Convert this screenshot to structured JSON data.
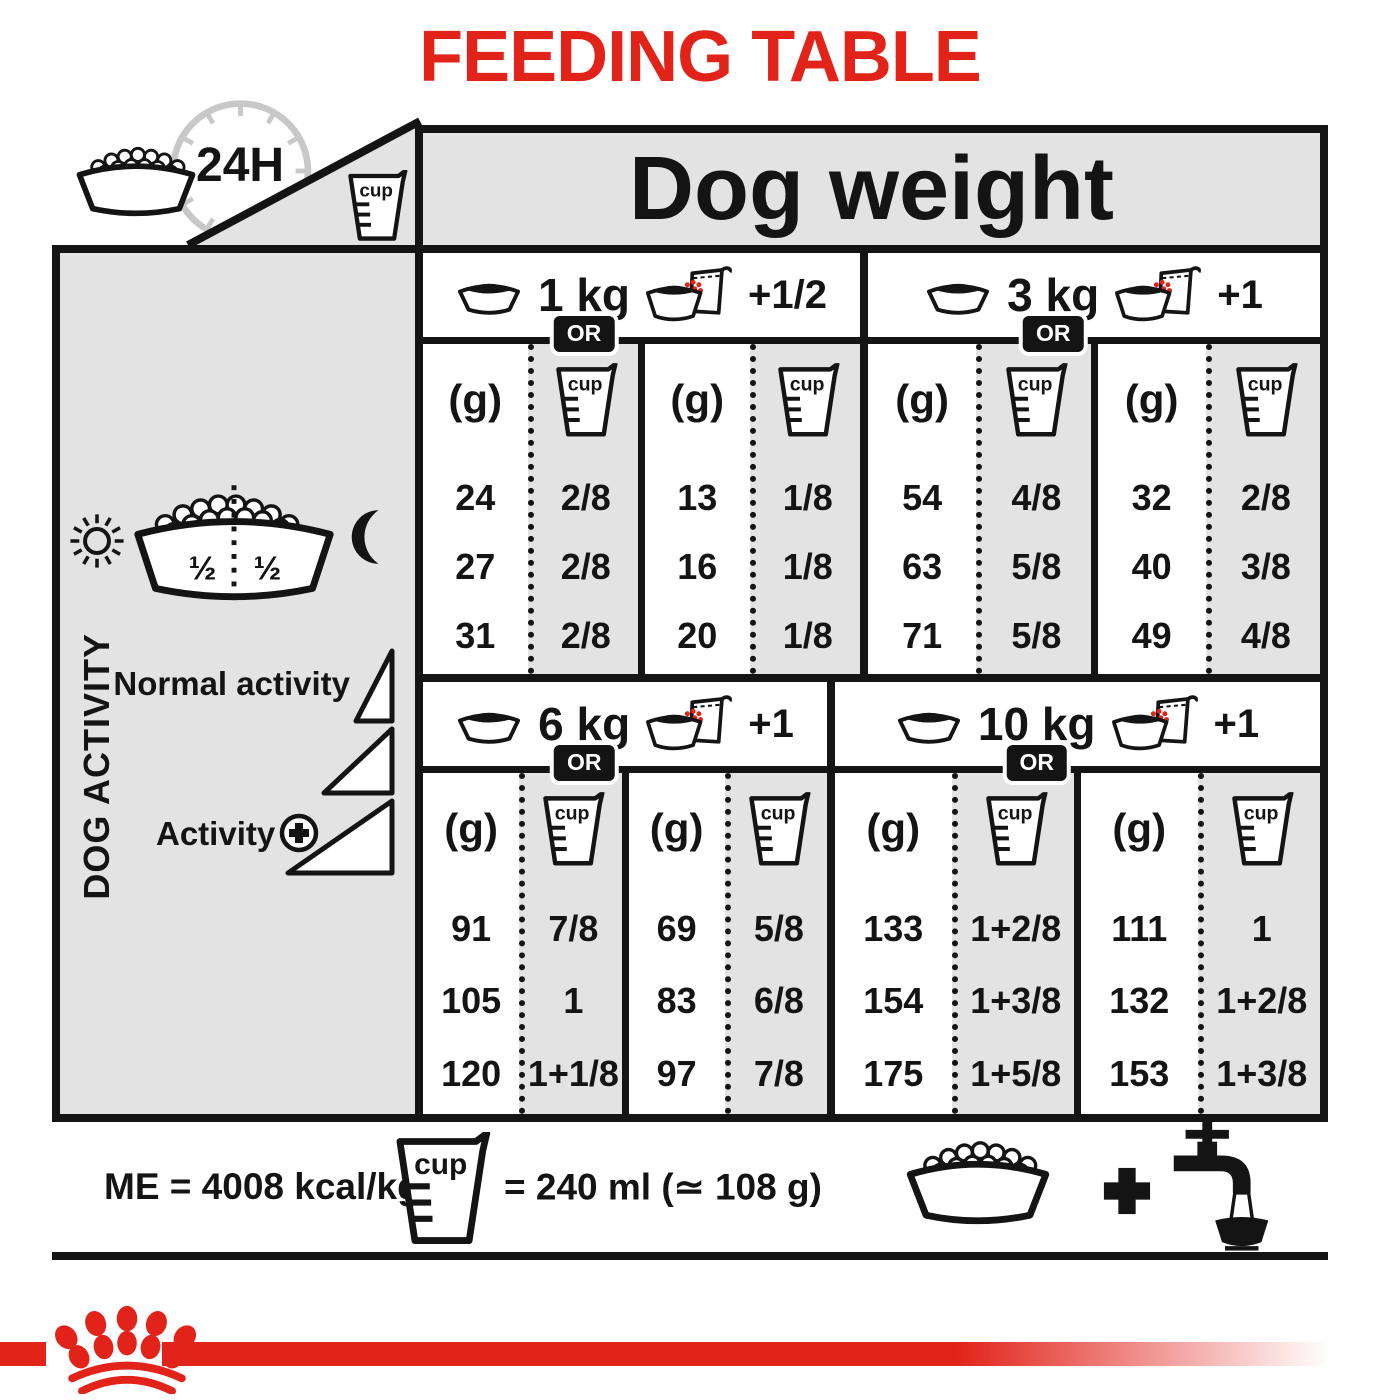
{
  "title": "FEEDING TABLE",
  "colors": {
    "accent_red": "#E2231A",
    "table_gray": "#E3E3E3",
    "clock_gray": "#C8C8C8",
    "ink": "#141414"
  },
  "icons": {
    "corner": [
      "kibble-bowl-icon",
      "24h-clock-icon",
      "measuring-cup-icon"
    ],
    "sidebar": [
      "sun-icon",
      "half-split-bowl-icon",
      "moon-icon",
      "activity-ramp-triangles",
      "plus-circle-icon"
    ],
    "quadrant_header": [
      "dry-bowl-icon",
      "bowl-with-pouch-icon"
    ],
    "footer": [
      "measuring-cup-icon",
      "kibble-bowl-icon",
      "plus-icon",
      "water-tap-bowl-icon",
      "crown-paw-logo"
    ]
  },
  "header": {
    "dog_weight_label": "Dog weight",
    "clock_label": "24H",
    "cup_label": "cup"
  },
  "sidebar": {
    "axis_label": "DOG ACTIVITY",
    "half_left": "½",
    "half_right": "½",
    "normal_activity_label": "Normal activity",
    "activity_label": "Activity"
  },
  "quadrants": [
    {
      "weight": "1 kg",
      "or_label": "OR",
      "plus_label": "+1/2",
      "g_header": "(g)",
      "full_g": [
        "24",
        "27",
        "31"
      ],
      "full_cup": [
        "2/8",
        "2/8",
        "2/8"
      ],
      "mixed_g": [
        "13",
        "16",
        "20"
      ],
      "mixed_cup": [
        "1/8",
        "1/8",
        "1/8"
      ]
    },
    {
      "weight": "3 kg",
      "or_label": "OR",
      "plus_label": "+1",
      "g_header": "(g)",
      "full_g": [
        "54",
        "63",
        "71"
      ],
      "full_cup": [
        "4/8",
        "5/8",
        "5/8"
      ],
      "mixed_g": [
        "32",
        "40",
        "49"
      ],
      "mixed_cup": [
        "2/8",
        "3/8",
        "4/8"
      ]
    },
    {
      "weight": "6 kg",
      "or_label": "OR",
      "plus_label": "+1",
      "g_header": "(g)",
      "full_g": [
        "91",
        "105",
        "120"
      ],
      "full_cup": [
        "7/8",
        "1",
        "1+1/8"
      ],
      "mixed_g": [
        "69",
        "83",
        "97"
      ],
      "mixed_cup": [
        "5/8",
        "6/8",
        "7/8"
      ]
    },
    {
      "weight": "10 kg",
      "or_label": "OR",
      "plus_label": "+1",
      "g_header": "(g)",
      "full_g": [
        "133",
        "154",
        "175"
      ],
      "full_cup": [
        "1+2/8",
        "1+3/8",
        "1+5/8"
      ],
      "mixed_g": [
        "111",
        "132",
        "153"
      ],
      "mixed_cup": [
        "1",
        "1+2/8",
        "1+3/8"
      ]
    }
  ],
  "footer": {
    "me_label": "ME = 4008 kcal/kg",
    "cup_label": "cup",
    "cup_equiv_label": "= 240 ml (≃ 108 g)"
  }
}
